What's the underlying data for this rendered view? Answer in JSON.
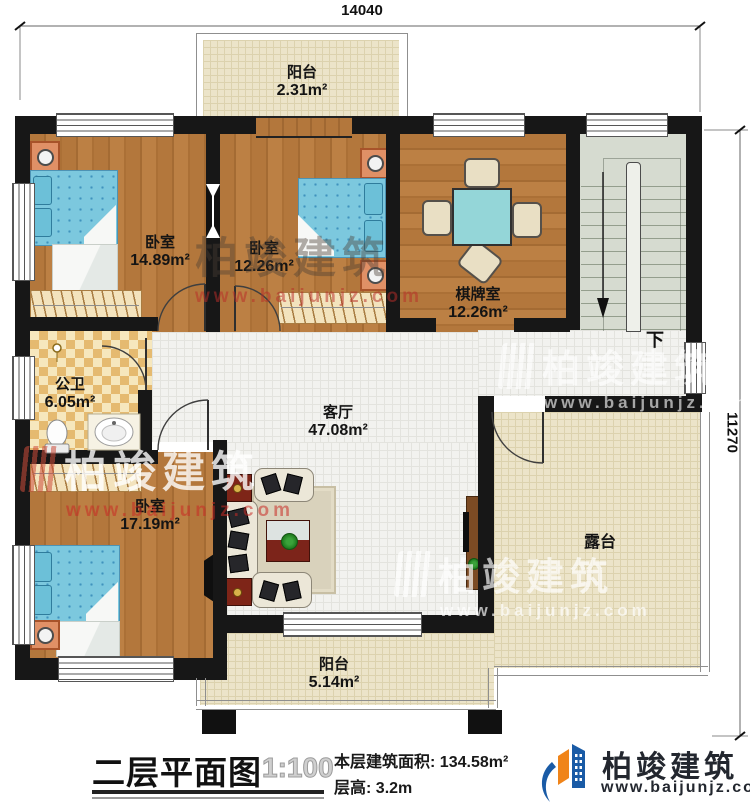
{
  "dimensions": {
    "top": "14040",
    "right": "11270"
  },
  "rooms": {
    "balcony_top": {
      "name": "阳台",
      "area": "2.31m²"
    },
    "bedroom_top_left": {
      "name": "卧室",
      "area": "14.89m²"
    },
    "bedroom_top_middle": {
      "name": "卧室",
      "area": "12.26m²"
    },
    "chess_room": {
      "name": "棋牌室",
      "area": "12.26m²"
    },
    "bathroom": {
      "name": "公卫",
      "area": "6.05m²"
    },
    "living_room": {
      "name": "客厅",
      "area": "47.08m²"
    },
    "bedroom_bottom_left": {
      "name": "卧室",
      "area": "17.19m²"
    },
    "terrace": {
      "name": "露台"
    },
    "balcony_bottom": {
      "name": "阳台",
      "area": "5.14m²"
    }
  },
  "stairs": {
    "direction_label": "下"
  },
  "footer": {
    "title": "二层平面图",
    "scale": "1:100",
    "area_label": "本层建筑面积:",
    "area_value": "134.58m²",
    "floor_height_label": "层高:",
    "floor_height_value": "3.2m"
  },
  "brand": {
    "name": "柏竣建筑",
    "url": "www.baijunjz.com"
  },
  "watermark": {
    "text": "柏竣建筑",
    "url": "www.baijunjz.com"
  },
  "colors": {
    "wall": "#171717",
    "wood": "#b3773c",
    "cream_tile": "#ece4c9",
    "white_tile": "#f2f2ef",
    "checker": "#e5ba70",
    "stairs": "#d6dbd0",
    "bed_blue": "#7cc8de",
    "table_teal": "#94d6d8",
    "brand_blue": "#1a5ba6",
    "brand_orange": "#f08419"
  }
}
